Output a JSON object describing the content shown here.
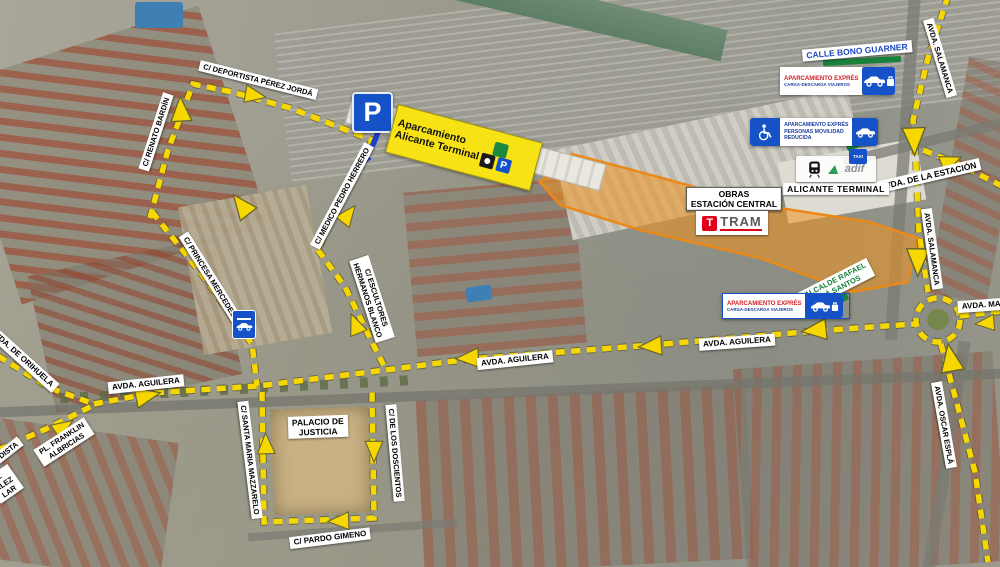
{
  "map_title": "Plano de accesos y aparcamientos - Alicante Terminal",
  "colors": {
    "route_yellow": "#f6d800",
    "obras_orange": "#f0921e",
    "sign_blue": "#1552c8",
    "red_text": "#d11f26",
    "blue_text": "#1d3f9e",
    "green_zone": "#15813b",
    "bono_blue": "#2148c0",
    "tram_red": "#e2001a"
  },
  "streets": {
    "deportista": "C/ DEPORTISTA PÉREZ JORDÁ",
    "renato": "C/ RENATO BARDÍN",
    "medico": "C/ MEDICO PEDRO HERRERO",
    "princesa": "C/ PRINCESA MERCEDES",
    "escultores_1": "C/ ESCULTORES",
    "escultores_2": "HERMANOS BLANCO",
    "orihuela": "AVDA. DE ORIHUELA",
    "aguilera_w": "AVDA. AGUILERA",
    "aguilera_c": "AVDA. AGUILERA",
    "aguilera_e": "AVDA. AGUILERA",
    "franklin_1": "PL. FRANKLIN",
    "franklin_2": "ALBRICIAS",
    "frag_periodista": "ODISTA",
    "frag2_l1": "L",
    "frag2_l2": "ALEZ",
    "frag2_l3": "LAR",
    "palacio_1": "PALACIO DE",
    "palacio_2": "JUSTICIA",
    "santa_maria": "C/ SANTA MARIA MAZZARELO",
    "doscientos": "C/ DE LOS DOSCIENTOS",
    "pardo": "C/ PARDO GIMENO",
    "salamanca_n": "AVDA. SALAMANCA",
    "salamanca_s": "AVDA. SALAMANCA",
    "estacion": "AVDA. DE LA ESTACIÓN",
    "bono": "CALLE BONO GUARNER",
    "maisonnave_frag": "AVDA. MAIS",
    "oscar": "AVDA. OSCAR ESPLÁ",
    "alcalde_1": "C/ ALCALDE RAFAEL",
    "alcalde_2": "MILLÁ SANTOS"
  },
  "signs": {
    "p_letter": "P",
    "aparcamiento_1": "Aparcamiento",
    "aparcamiento_2": "Alicante Terminal",
    "expres_title": "APARCAMIENTO EXPRÉS",
    "expres_sub": "CARGA-DESCARGA VIAJEROS",
    "pmr_1": "APARCAMIENTO EXPRÉS",
    "pmr_2": "PERSONAS MOVILIDAD",
    "pmr_3": "REDUCIDA",
    "taxi": "TAXI",
    "alicante_terminal": "ALICANTE TERMINAL",
    "adif": "adif",
    "obras_1": "OBRAS",
    "obras_2": "ESTACIÓN CENTRAL",
    "tram": "TRAM"
  }
}
